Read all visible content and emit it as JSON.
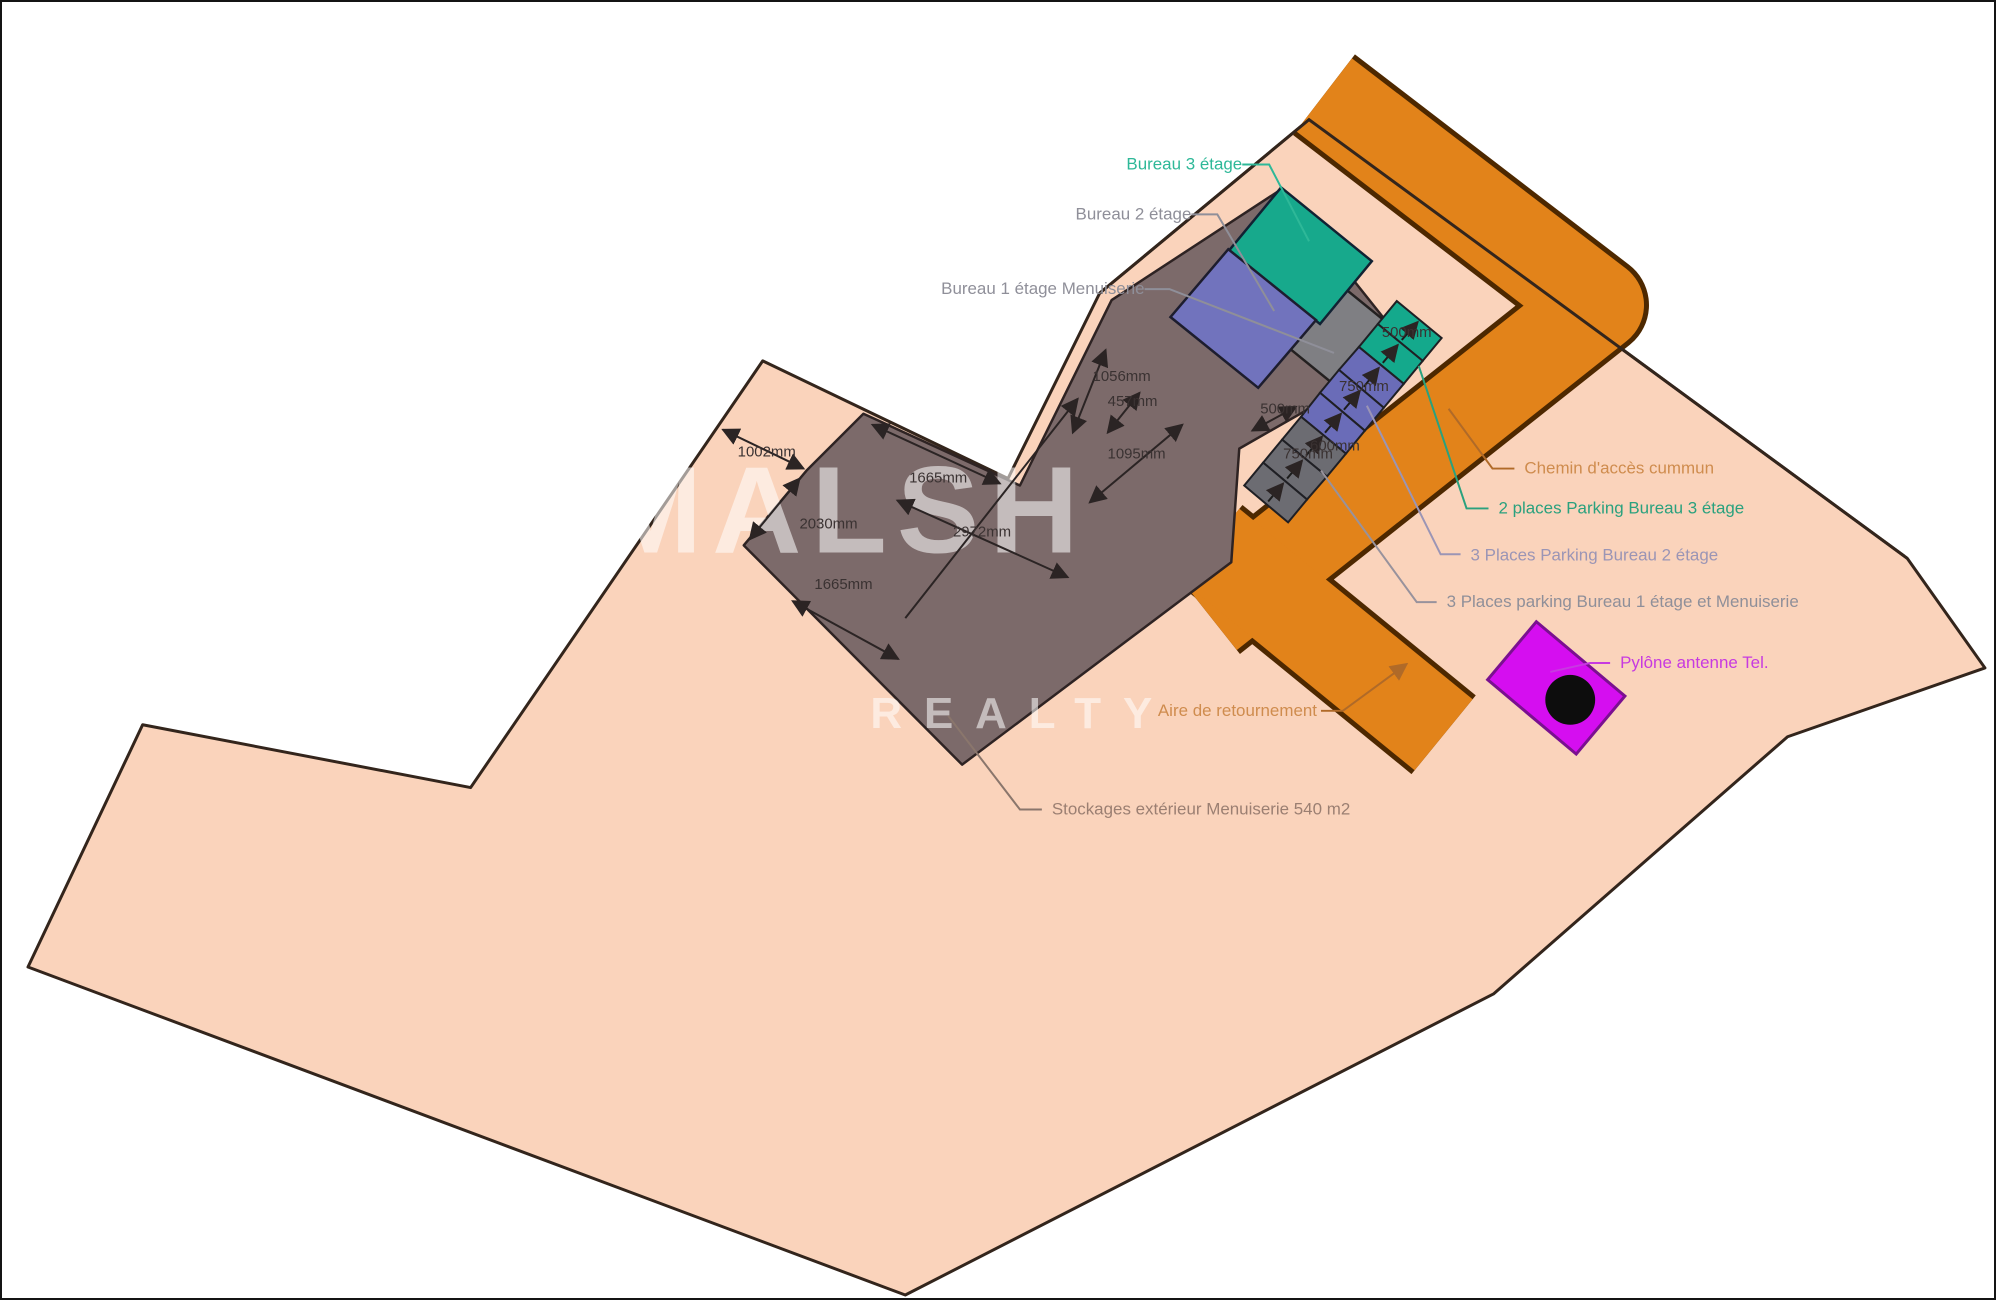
{
  "watermark": {
    "line1": "MALSH",
    "line2": "REALTY"
  },
  "buildings": {
    "bureau3_label": "Bureau 3 étage",
    "bureau2_label": "Bureau 2 étage",
    "bureau1_label": "Bureau 1 étage Menuiserie",
    "stockages_label": "Stockages extérieur Menuiserie 540 m2"
  },
  "roads": {
    "chemin_label": "Chemin d'accès cummun",
    "aire_label": "Aire de retournement"
  },
  "parking": {
    "p3_label": "2 places Parking Bureau 3 étage",
    "p2_label": "3 Places Parking Bureau 2 étage",
    "p1_label": "3 Places parking Bureau 1 étage et Menuiserie"
  },
  "pylon": {
    "label": "Pylône antenne Tel."
  },
  "dimensions": {
    "dim_1002": "1002mm",
    "dim_1665_top": "1665mm",
    "dim_2030": "2030mm",
    "dim_2972": "2972mm",
    "dim_1665_bottom": "1665mm",
    "dim_1056": "1056mm",
    "dim_457": "457mm",
    "dim_1095": "1095mm",
    "dim_500_gap": "500mm",
    "dim_500_p3": "500mm",
    "dim_750_p2": "750mm",
    "dim_600_p1": "600mm",
    "dim_750_p1": "750mm"
  },
  "colors": {
    "parcel": "#fad3bb",
    "parcel_outline": "#33251c",
    "road": "#e2831a",
    "road_outline": "#4d2800",
    "building": "#7c6a6a",
    "building_outline": "#2e2323",
    "bureau3": "#17a98c",
    "bureau2": "#7173bd",
    "bureau1_floor": "#7f7f83",
    "parking_teal": "#14a98c",
    "parking_purple": "#6a6cb8",
    "parking_gray": "#6c6c72",
    "pylon_fill": "#d50ef0",
    "pylon_outline": "#7a1090",
    "text_teal": "#2eb898",
    "text_gray": "#8f8f99",
    "text_orange": "#cf8c4e",
    "text_green": "#2aa17e",
    "text_purplegray": "#9b95b5",
    "text_magenta": "#c73ae0",
    "text_taupe": "#9b7f72",
    "text_dim": "#3a3232"
  }
}
